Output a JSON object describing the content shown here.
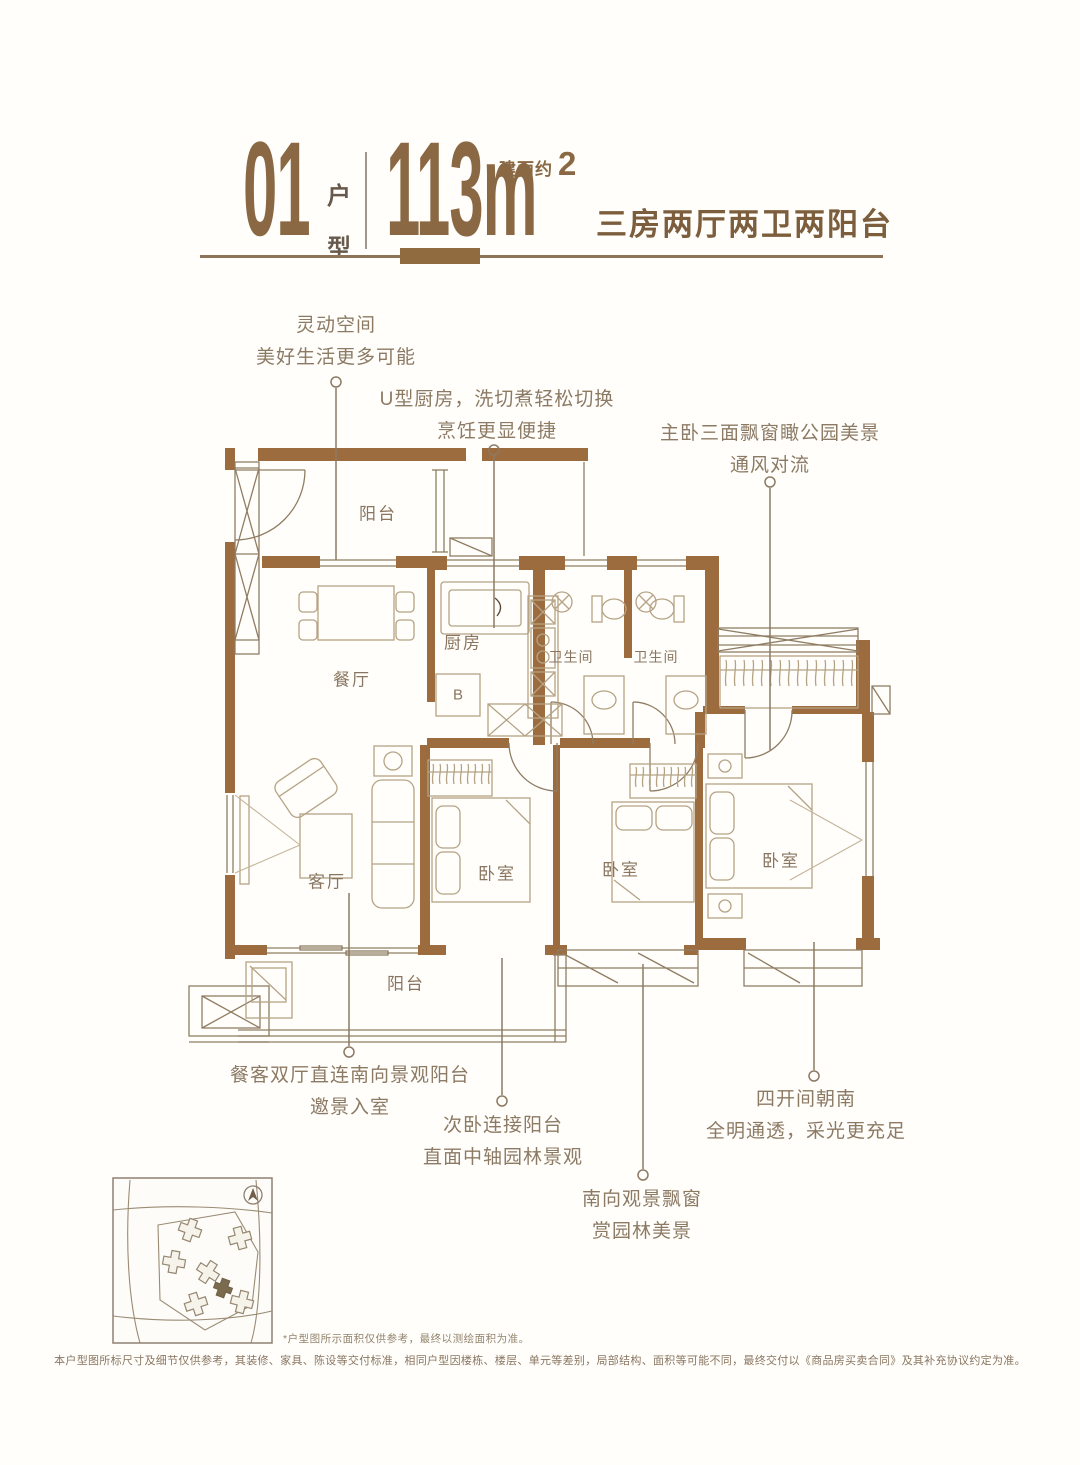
{
  "header": {
    "unit_number": "01",
    "unit_label": [
      "户",
      "型"
    ],
    "area_prefix": "建面约",
    "area_value_unit": "113m",
    "area_exponent": "2",
    "layout_desc": "三房两厅两卫两阳台"
  },
  "rooms": {
    "balcony_top": "阳台",
    "dining": "餐厅",
    "kitchen": "厨房",
    "kitchen_zone": "B",
    "bathroom_1": "卫生间",
    "bathroom_2": "卫生间",
    "living": "客厅",
    "bedroom_left": "卧室",
    "bedroom_middle": "卧室",
    "bedroom_master": "卧室",
    "balcony_bottom": "阳台"
  },
  "callouts": {
    "flexible_space": {
      "lines": [
        "灵动空间",
        "美好生活更多可能"
      ]
    },
    "kitchen": {
      "lines": [
        "U型厨房，洗切煮轻松切换",
        "烹饪更显便捷"
      ]
    },
    "master": {
      "lines": [
        "主卧三面飘窗瞰公园美景",
        "通风对流"
      ]
    },
    "dining_living": {
      "lines": [
        "餐客双厅直连南向景观阳台",
        "邀景入室"
      ]
    },
    "secondary_bedroom": {
      "lines": [
        "次卧连接阳台",
        "直面中轴园林景观"
      ]
    },
    "bay_window": {
      "lines": [
        "南向观景飘窗",
        "赏园林美景"
      ]
    },
    "south_facing": {
      "lines": [
        "四开间朝南",
        "全明通透，采光更充足"
      ]
    }
  },
  "notes": {
    "footnote": "*户型图所示面积仅供参考，最终以测绘面积为准。",
    "disclaimer": "本户型图所标尺寸及细节仅供参考，其装修、家具、陈设等交付标准，相同户型因楼栋、楼层、单元等差别，局部结构、面积等可能不同，最终交付以《商品房买卖合同》及其补充协议约定为准。"
  },
  "colors": {
    "title_brown": "#8a6843",
    "wall_brown": "#9c6b3e",
    "callout_text": "#8c7a64",
    "accent_bar": "#8f6b3f"
  }
}
